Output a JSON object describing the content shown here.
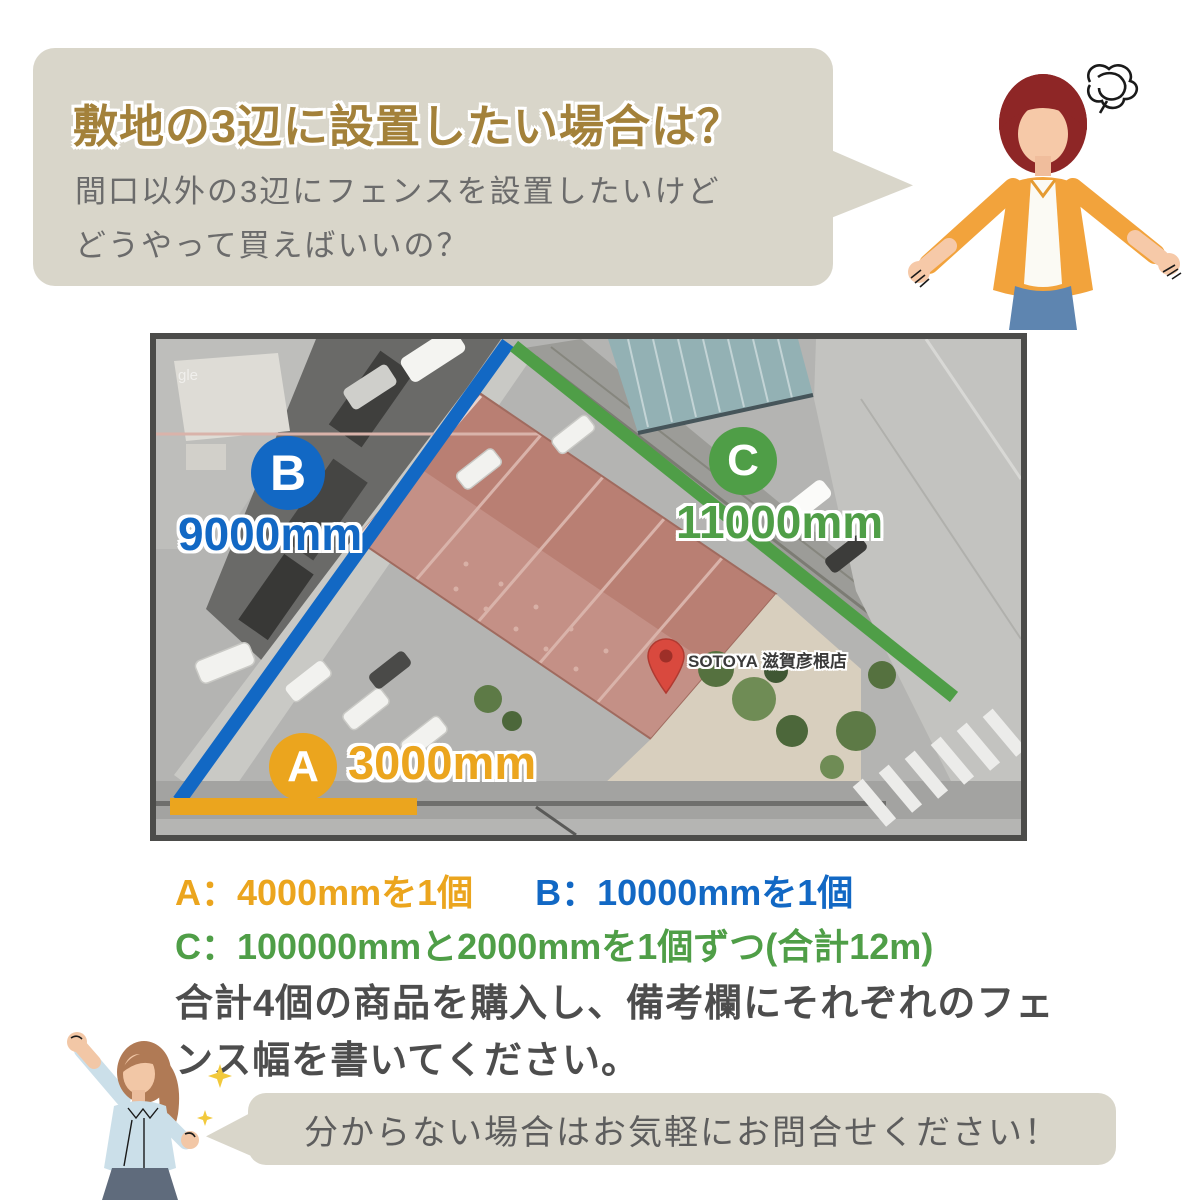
{
  "question_bubble": {
    "title": "敷地の3辺に設置したい場合は？",
    "line1": "間口以外の3辺にフェンスを設置したいけど",
    "line2": "どうやって買えばいいの？",
    "bg_color": "#d9d6ca",
    "title_color": "#a3813a"
  },
  "map": {
    "watermark": "gle",
    "pin_label": "SOTOYA 滋賀彦根店",
    "sides": [
      {
        "id": "A",
        "length": "3000mm",
        "color": "#eba51e"
      },
      {
        "id": "B",
        "length": "9000mm",
        "color": "#1268c4"
      },
      {
        "id": "C",
        "length": "11000mm",
        "color": "#4f9e47"
      }
    ]
  },
  "purchase_info": {
    "item_a": "A：4000mmを1個",
    "item_b": "B：10000mmを1個",
    "item_c": "C：100000mmと2000mmを1個ずつ(合計12m)",
    "note_line1": "合計4個の商品を購入し、備考欄にそれぞれのフェ",
    "note_line2": "ンス幅を書いてください。"
  },
  "contact_bubble": {
    "message": "分からない場合はお気軽にお問合せください！",
    "bg_color": "#d9d6ca"
  },
  "illustrations": {
    "top_right": "confused-woman-icon",
    "bottom_left": "cheering-woman-icon"
  }
}
